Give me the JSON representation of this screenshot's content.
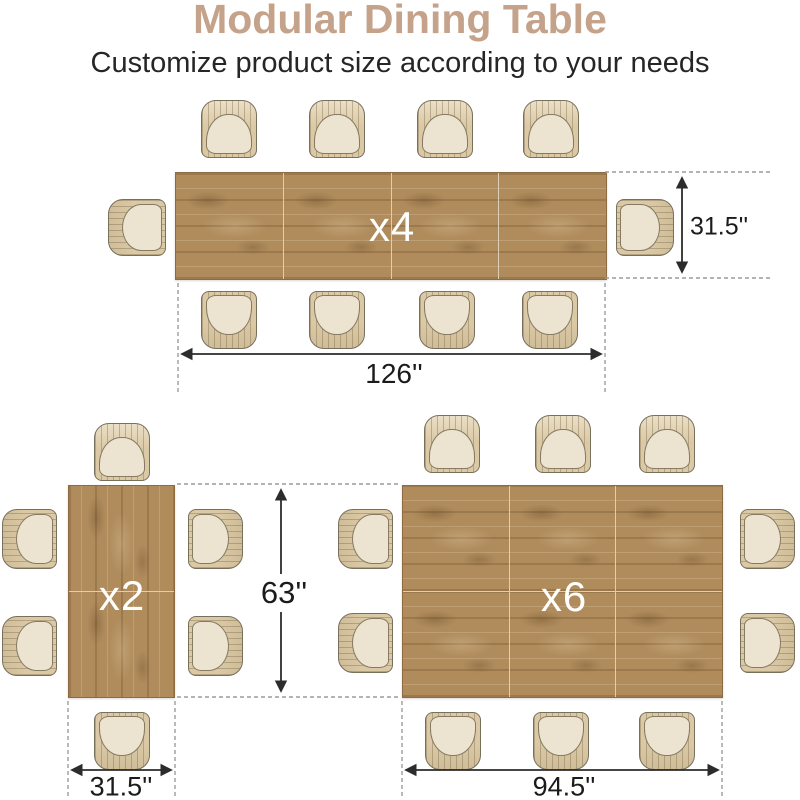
{
  "header": {
    "title": "Modular Dining Table",
    "subtitle": "Customize product size according to your needs"
  },
  "configurations": {
    "x4": {
      "count": "x4",
      "length": "126''",
      "depth": "31.5''"
    },
    "x2": {
      "count": "x2",
      "width": "31.5''",
      "height": "63''"
    },
    "x6": {
      "count": "x6",
      "width": "94.5''"
    }
  },
  "colors": {
    "title_text": "#c5a28a",
    "subtitle_text": "#262626",
    "table_wood": "#b08c5c",
    "chair_shell": "#dbc9a6",
    "chair_seat": "#ece4d1",
    "count_text": "#ffffff",
    "dimension_text": "#1b1b1b",
    "dimension_line": "#2c2c2c",
    "dashed_guide": "#9c9c9c"
  }
}
